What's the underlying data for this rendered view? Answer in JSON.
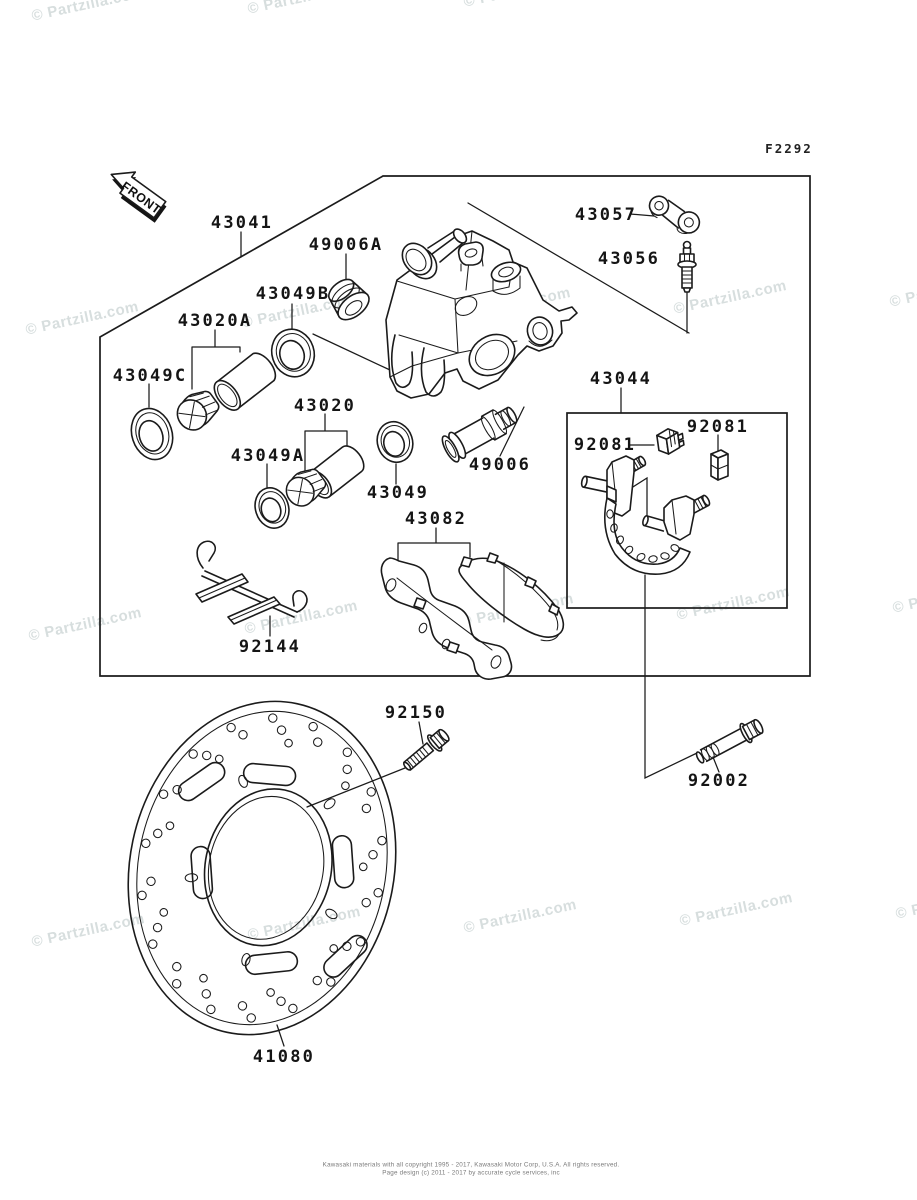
{
  "doc": {
    "figure_code": "F2292",
    "front_arrow": "FRONT",
    "watermark": "© Partzilla.com",
    "footer_line1": "Kawasaki materials with all copyright 1995 - 2017, Kawasaki Motor Corp, U.S.A. All rights reserved.",
    "footer_line2": "Page design (c) 2011 - 2017 by accurate cycle services, inc"
  },
  "labels": {
    "p43041": "43041",
    "p49006a": "49006A",
    "p43049b": "43049B",
    "p43020a": "43020A",
    "p43049c": "43049C",
    "p43057": "43057",
    "p43056": "43056",
    "p43020": "43020",
    "p43049a": "43049A",
    "p43049": "43049",
    "p49006": "49006",
    "p43044": "43044",
    "p92081": "92081",
    "p43082": "43082",
    "p92144": "92144",
    "p92150": "92150",
    "p92002": "92002",
    "p41080": "41080"
  }
}
